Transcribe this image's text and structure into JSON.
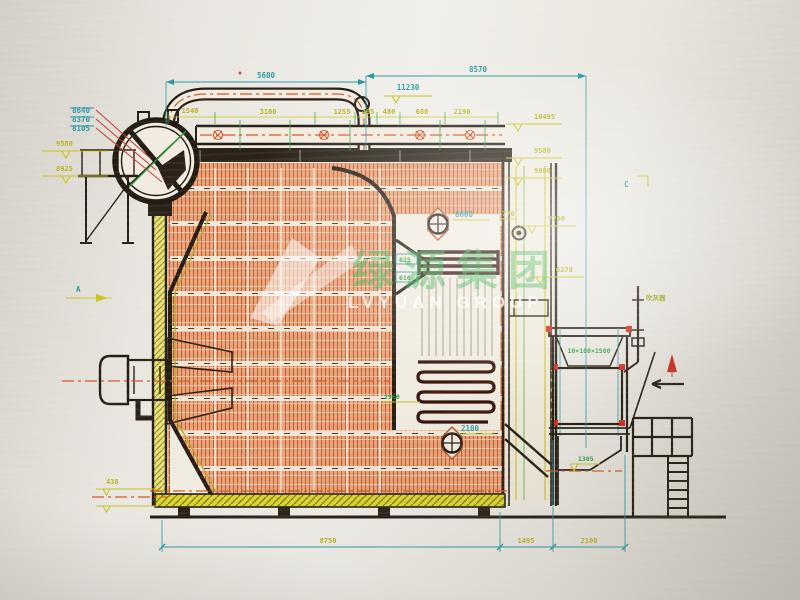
{
  "watermark": {
    "cn": "绿源集团",
    "en": "LVYUAN GROUP"
  },
  "dims": {
    "top": [
      "5600",
      "8570",
      "11230"
    ],
    "chain": [
      "1540",
      "3100",
      "1255",
      "465",
      "480",
      "680",
      "2190"
    ],
    "relev": [
      "10495",
      "9580",
      "9080",
      "7700",
      "6270"
    ],
    "lelev": [
      "9580",
      "8925"
    ],
    "lstack": [
      "8640",
      "8370",
      "8105"
    ],
    "inner": {
      "manhole_upper": "8600",
      "offset": "770",
      "mid": "2960",
      "manhole_lower": "2100",
      "coil_a": "625",
      "coil_b": "610"
    },
    "bottom": [
      "8750",
      "1495",
      "2100"
    ],
    "misc": {
      "ash": "1305",
      "base": "438"
    }
  },
  "markers": {
    "a": "A",
    "c": "C"
  },
  "labels": {
    "econ_spec": "10×100×1500",
    "soot_blower": "吹灰器"
  }
}
